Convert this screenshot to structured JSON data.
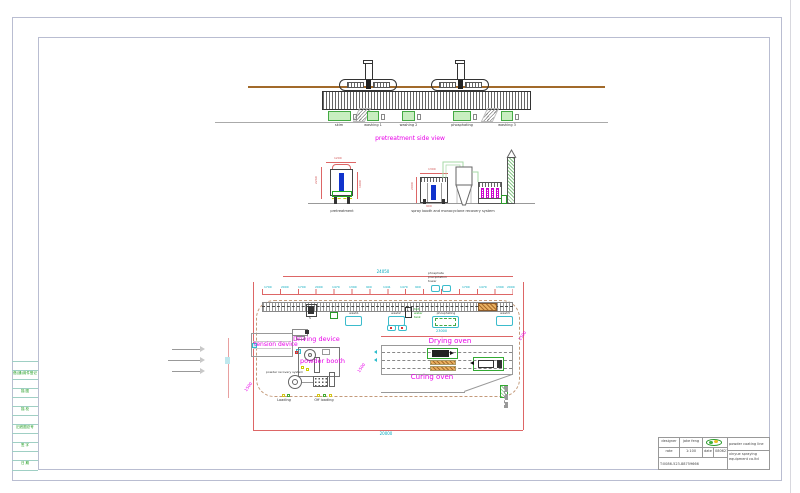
{
  "frame": {
    "margin_cells": [
      "借(通)用件登记",
      "描 图",
      "描 校",
      "旧底图总号",
      "签 字",
      "日 期"
    ]
  },
  "colors": {
    "magenta_label": "#e800e8",
    "cyan_dim": "#00a8bc",
    "red_dim": "#d05050",
    "green_text": "#1a9a1a",
    "tank_fill": "#c8eec0",
    "rail_brown": "#a26a2a",
    "workpiece_blue": "#1133cc"
  },
  "side_view": {
    "title": "pretreatment side view",
    "tank_labels": [
      "skim",
      "washing 1",
      "washing 2",
      "phosphating",
      "washing 3"
    ]
  },
  "elevations": {
    "left_label": "pretreatment",
    "right_label": "spray booth and monocyclone recovery system",
    "red_dims": [
      "2260",
      "1200",
      "1900",
      "1300",
      "2000",
      "900"
    ]
  },
  "plan": {
    "dim_total_top": "24050",
    "dim_total_bottom": "20000",
    "dim_oven": "23000",
    "tick_dims": [
      "1700",
      "2000",
      "1700",
      "2000",
      "1470",
      "1390",
      "900",
      "1441",
      "1470",
      "900",
      "1700",
      "1470",
      "1390",
      "2000"
    ],
    "diag_dims": [
      "1500",
      "1500",
      "1500"
    ],
    "tower_note_lines": [
      "phosphate",
      "precipitation",
      "tower"
    ],
    "tank_labels": [
      "wash1",
      "wash2",
      "phosphating",
      "wash3"
    ],
    "hot_water_lines": [
      "hot",
      "water",
      "tank"
    ],
    "driving_device": "Driving device",
    "tension_device": "tension device",
    "powder_booth": "powder booth",
    "powder_recovery": "powder recovery system",
    "drying_oven": "Drying oven",
    "curing_oven": "Curing oven",
    "loading": "Loading",
    "offloading": "Off loading",
    "pump_s": "S"
  },
  "title_block": {
    "designer_label": "designer",
    "designer": "jake feng",
    "rate_label": "rate",
    "rate": "1:100",
    "date_label": "date",
    "date": "080627",
    "phone": "T:0086-523-88759666",
    "product": "powder coating line",
    "company": "xinyue spraying equipment co.ltd"
  }
}
